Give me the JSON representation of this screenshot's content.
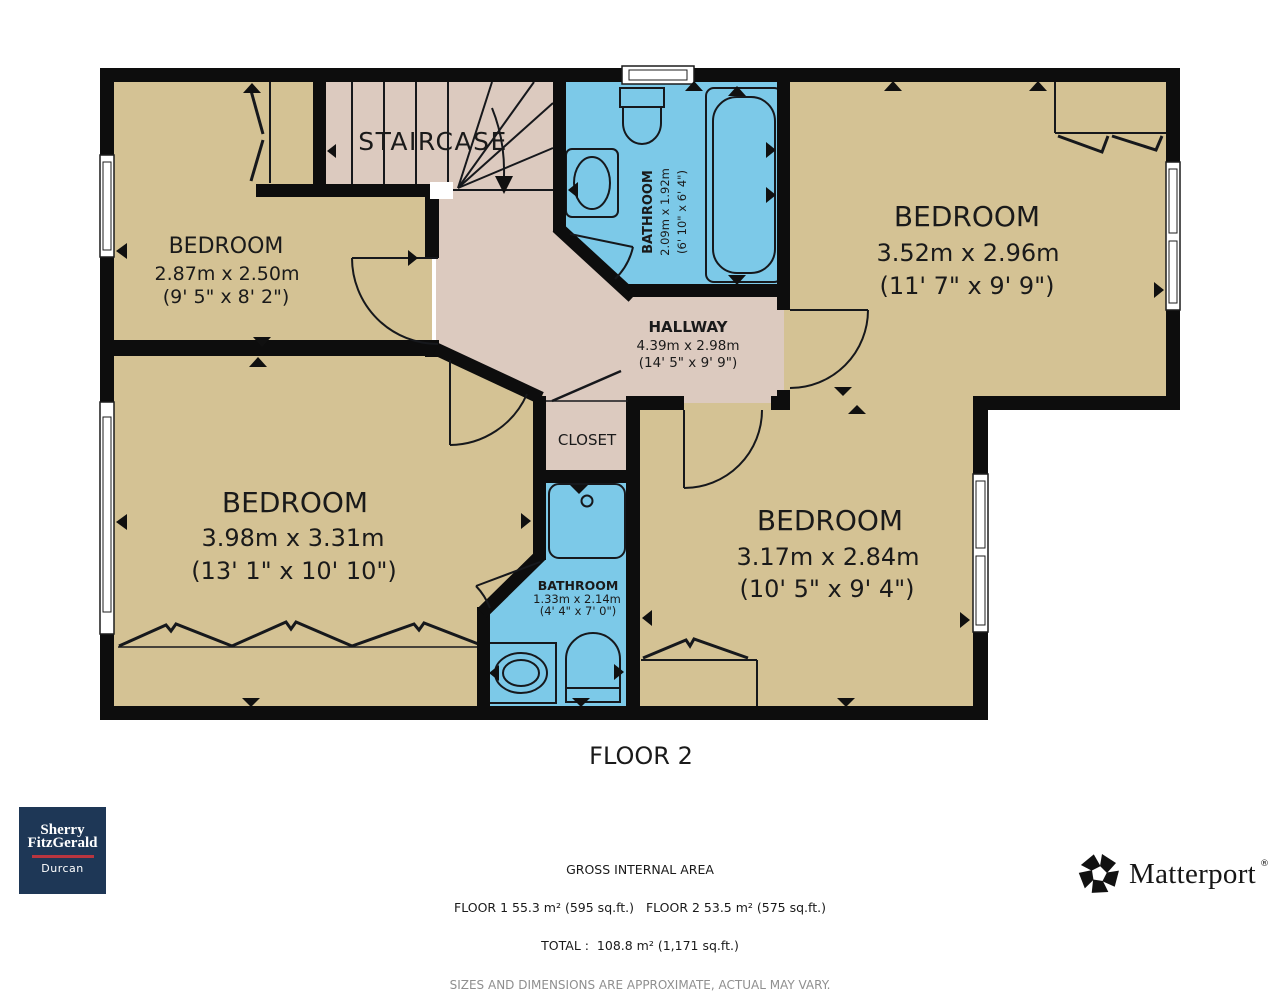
{
  "plan": {
    "floor_label": "FLOOR 2",
    "colors": {
      "room_fill": "#d4c294",
      "circulation_fill": "#dccabf",
      "bathroom_fill": "#7cc9e8",
      "wall": "#0d0d0d"
    },
    "rooms": {
      "bedroom_top_left": {
        "name": "BEDROOM",
        "dim_metric": "2.87m x 2.50m",
        "dim_imperial": "(9' 5\" x 8' 2\")"
      },
      "staircase": {
        "name": "STAIRCASE"
      },
      "bathroom_top": {
        "name": "BATHROOM",
        "dim_metric": "2.09m x 1.92m",
        "dim_imperial": "(6' 10\" x 6' 4\")"
      },
      "bedroom_top_right": {
        "name": "BEDROOM",
        "dim_metric": "3.52m x 2.96m",
        "dim_imperial": "(11' 7\" x 9' 9\")"
      },
      "hallway": {
        "name": "HALLWAY",
        "dim_metric": "4.39m x 2.98m",
        "dim_imperial": "(14' 5\" x 9' 9\")"
      },
      "closet": {
        "name": "CLOSET"
      },
      "bedroom_bottom_left": {
        "name": "BEDROOM",
        "dim_metric": "3.98m x 3.31m",
        "dim_imperial": "(13' 1\" x 10' 10\")"
      },
      "bathroom_bottom": {
        "name": "BATHROOM",
        "dim_metric": "1.33m x 2.14m",
        "dim_imperial": "(4' 4\" x 7' 0\")"
      },
      "bedroom_bottom_right": {
        "name": "BEDROOM",
        "dim_metric": "3.17m x 2.84m",
        "dim_imperial": "(10' 5\" x 9' 4\")"
      }
    }
  },
  "footer": {
    "gross_title": "GROSS INTERNAL AREA",
    "floors_line": "FLOOR 1 55.3 m² (595 sq.ft.)   FLOOR 2 53.5 m² (575 sq.ft.)",
    "total_line": "TOTAL :  108.8 m² (1,171 sq.ft.)",
    "disclaimer": "SIZES AND DIMENSIONS ARE APPROXIMATE, ACTUAL MAY VARY."
  },
  "branding": {
    "agency": {
      "name_line1": "Sherry",
      "name_line2": "FitzGerald",
      "office": "Durcan",
      "bg_color": "#1e3756",
      "accent_color": "#b9353f"
    },
    "matterport": {
      "wordmark": "Matterport",
      "registered_mark": "®"
    }
  }
}
